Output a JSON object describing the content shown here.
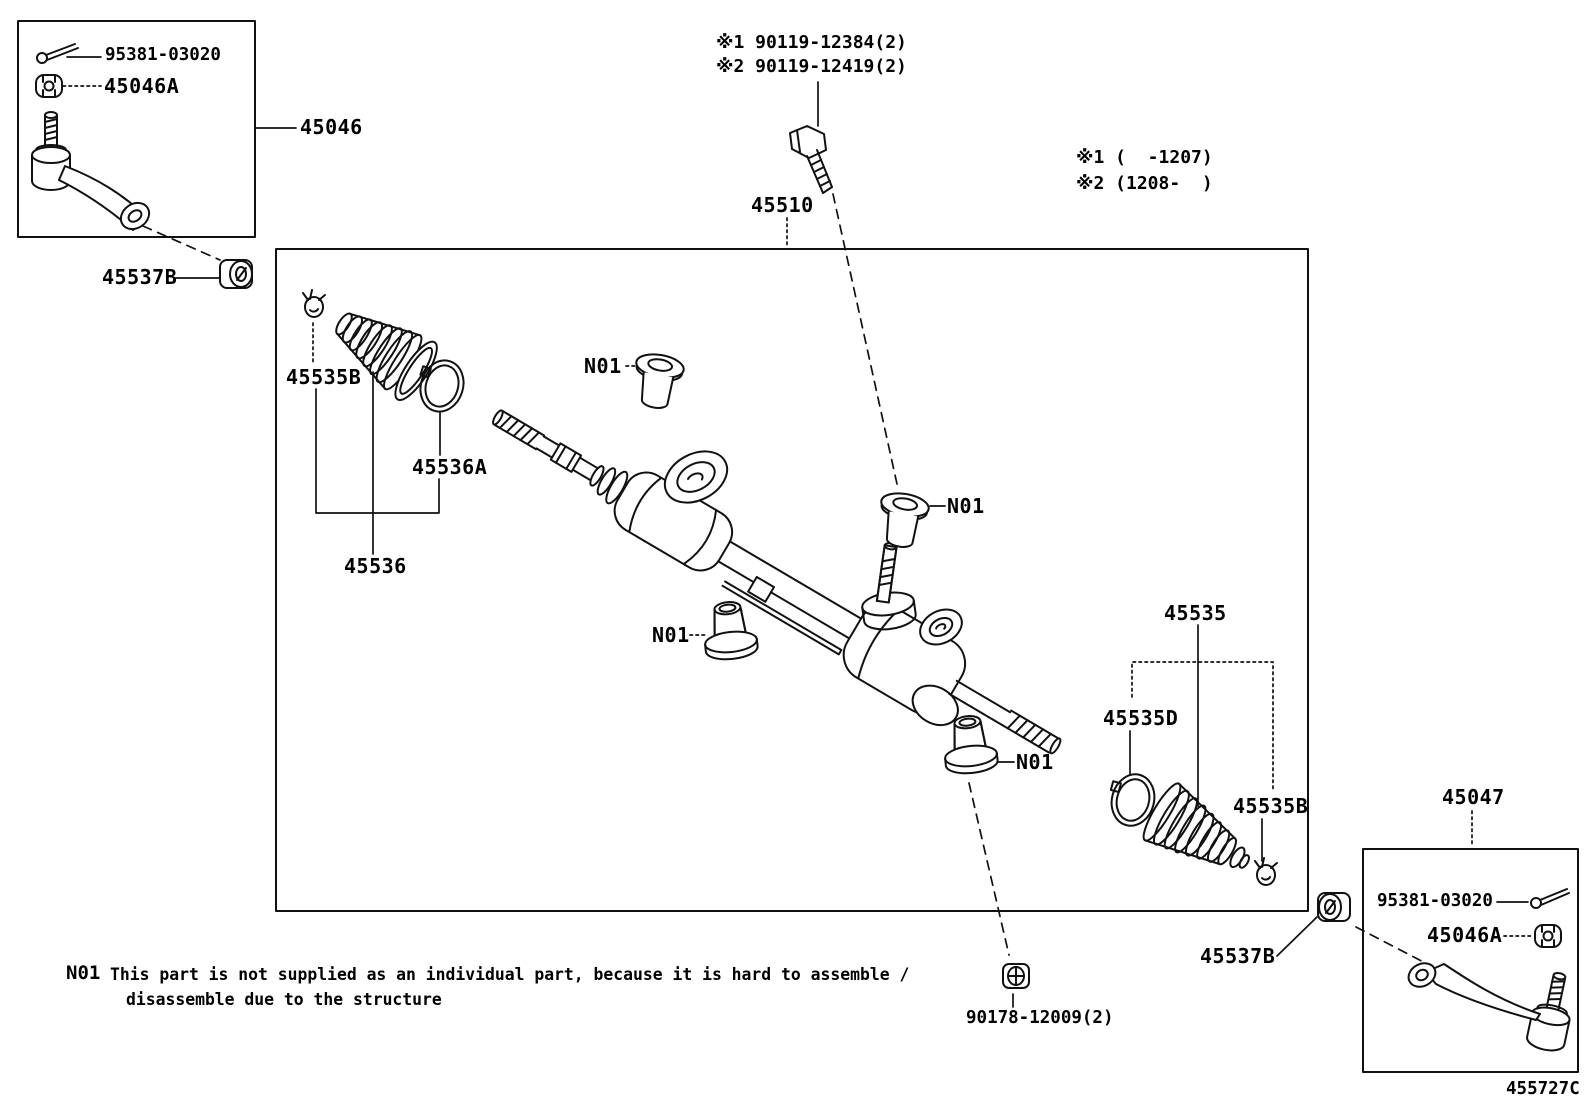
{
  "figure": {
    "code": "455727C"
  },
  "left_tie_rod_box": {
    "cotter_pin": "95381-03020",
    "castle_nut": "45046A",
    "assembly": "45046",
    "lock_nut": "45537B"
  },
  "bolt_refs": {
    "ref1": "※1 90119-12384(2)",
    "ref2": "※2 90119-12419(2)"
  },
  "applicability": {
    "ref1": "※1 (  -1207)",
    "ref2": "※2 (1208-  )"
  },
  "gear": {
    "assembly": "45510",
    "grommet": "N01"
  },
  "left_boot_group": {
    "clip": "45535B",
    "clamp": "45536A",
    "boot_kit": "45536"
  },
  "right_boot_group": {
    "boot_kit": "45535",
    "clamp": "45535D",
    "clip": "45535B"
  },
  "right_tie_rod_box": {
    "assembly": "45047",
    "cotter_pin": "95381-03020",
    "castle_nut": "45046A",
    "lock_nut": "45537B"
  },
  "rack_nut": "90178-12009(2)",
  "footnote": {
    "ref": "N01",
    "line1": "This part is not supplied as an individual part, because it is hard to assemble /",
    "line2": "disassemble due to the structure"
  }
}
